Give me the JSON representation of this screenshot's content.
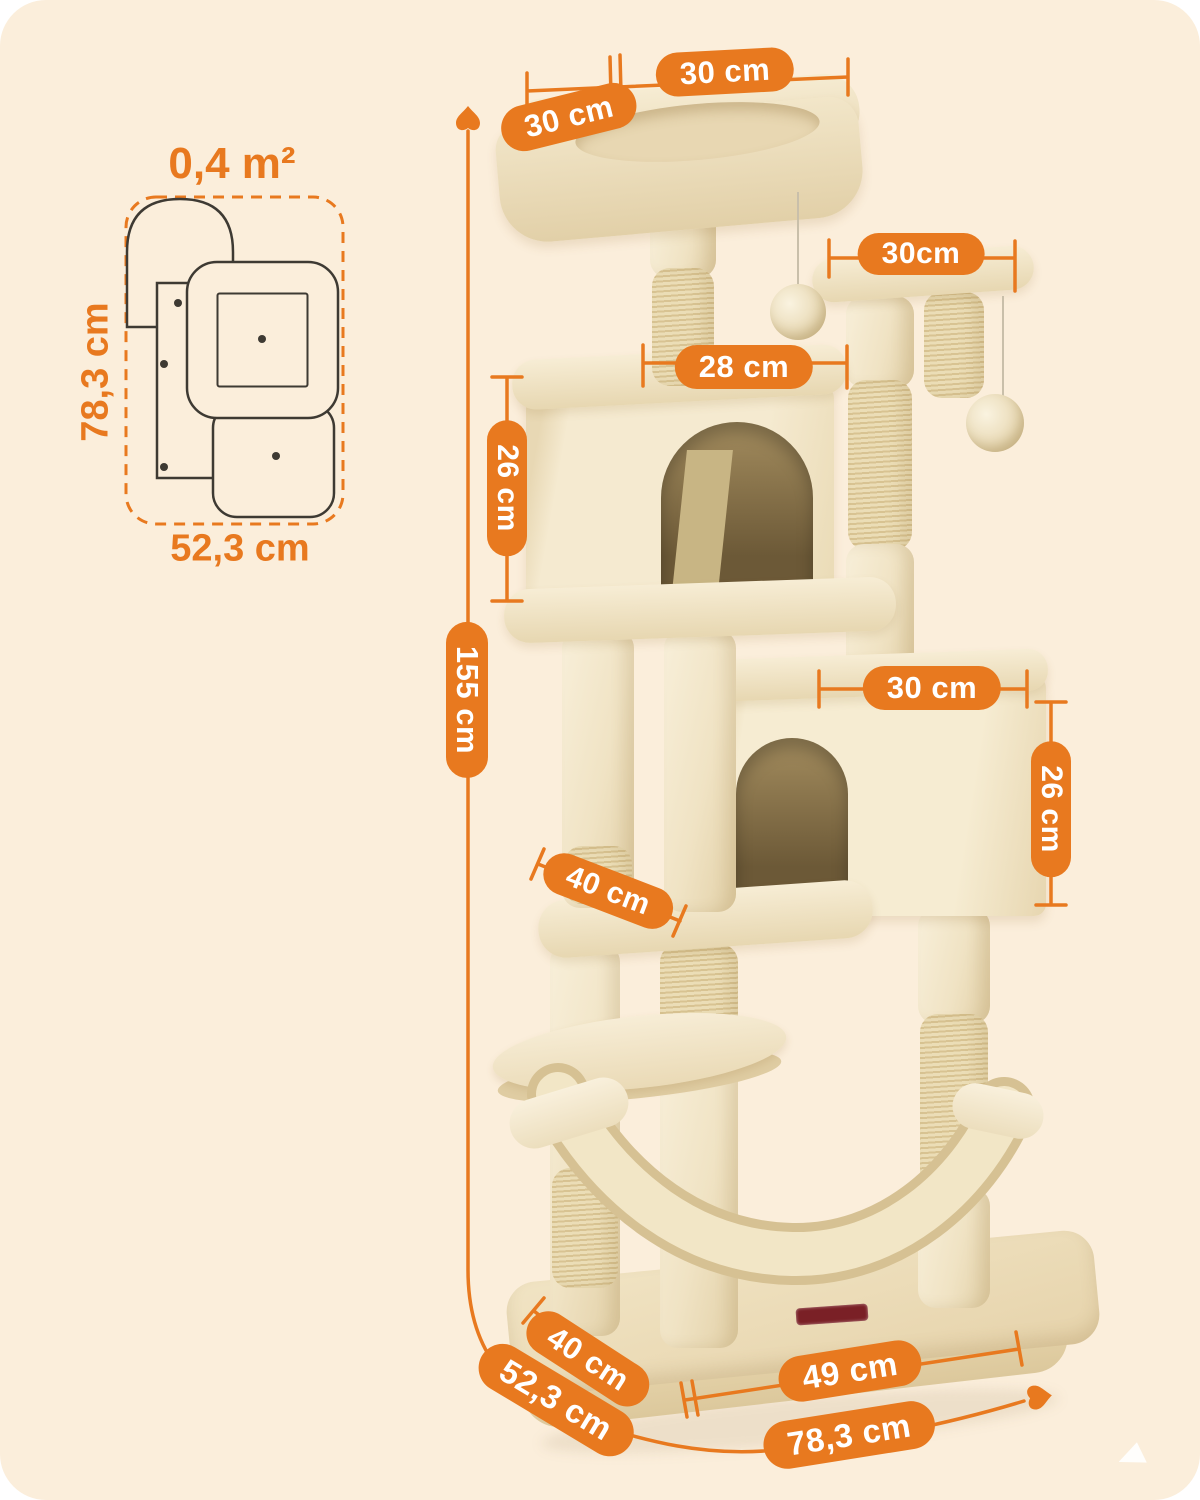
{
  "colors": {
    "background": "#FFFFFF",
    "canvas": "#FBEEDB",
    "accent": "#E8791F",
    "outline": "#3E3A33",
    "plush": "#F3E7CB",
    "sisal": "#E7D8B0",
    "house_interior": "#6C5937",
    "brand_tag": "#7A2026"
  },
  "footprint": {
    "area_label": "0,4 m²",
    "depth_label": "78,3 cm",
    "width_label": "52,3 cm"
  },
  "dimensions": {
    "top_bed_width": "30 cm",
    "top_bed_depth": "30 cm",
    "upper_platform_width": "30cm",
    "upper_house_width": "28 cm",
    "upper_house_height": "26 cm",
    "total_height": "155 cm",
    "lower_house_width": "30 cm",
    "lower_house_height": "26 cm",
    "middle_platform_width": "40 cm",
    "base_depth": "40 cm",
    "base_width": "49 cm",
    "floor_diagonal_depth": "52,3 cm",
    "floor_width": "78,3 cm"
  }
}
